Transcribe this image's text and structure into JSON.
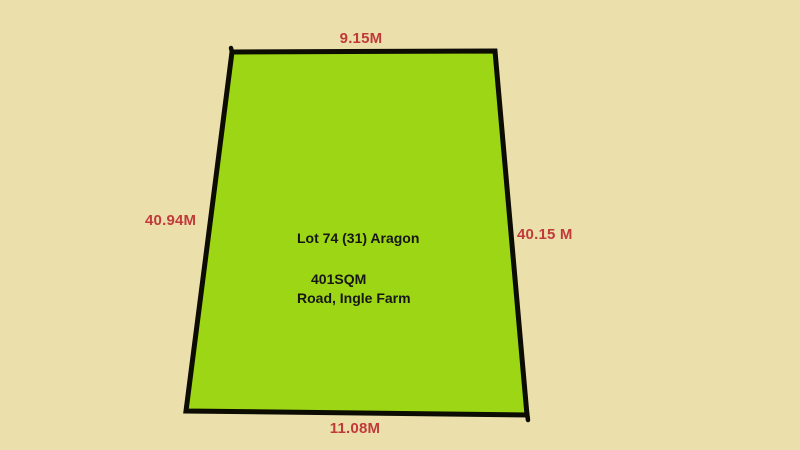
{
  "diagram": {
    "type": "land-lot-plan",
    "lot": {
      "address_line1": "Lot 74 (31) Aragon",
      "address_line2": "Road, Ingle Farm",
      "area_label": "401SQM"
    },
    "dimensions": {
      "top": "9.15M",
      "left": "40.94M",
      "right": "40.15 M",
      "bottom": "11.08M"
    },
    "colors": {
      "background": "#EBDFAC",
      "lot_fill": "#9DD614",
      "lot_outline": "#0C0C02",
      "dimension_text": "#C13A3A",
      "lot_text": "#161616"
    }
  }
}
